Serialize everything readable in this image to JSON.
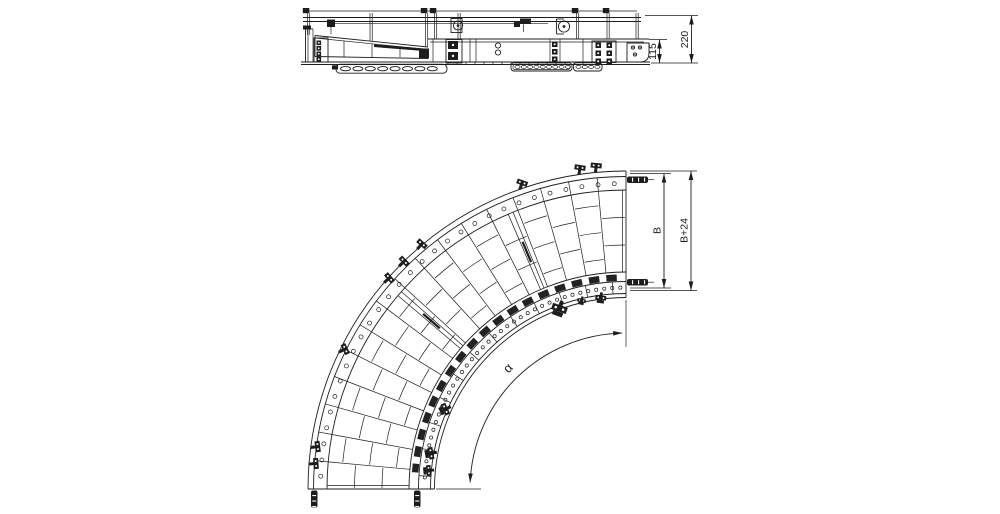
{
  "drawing": {
    "side_view": {
      "dim_total_height": "220",
      "dim_conveyor_height": "115"
    },
    "plan_view": {
      "dim_belt_width": "B",
      "dim_overall_width": "B+24",
      "dim_curve_angle": "α"
    }
  }
}
